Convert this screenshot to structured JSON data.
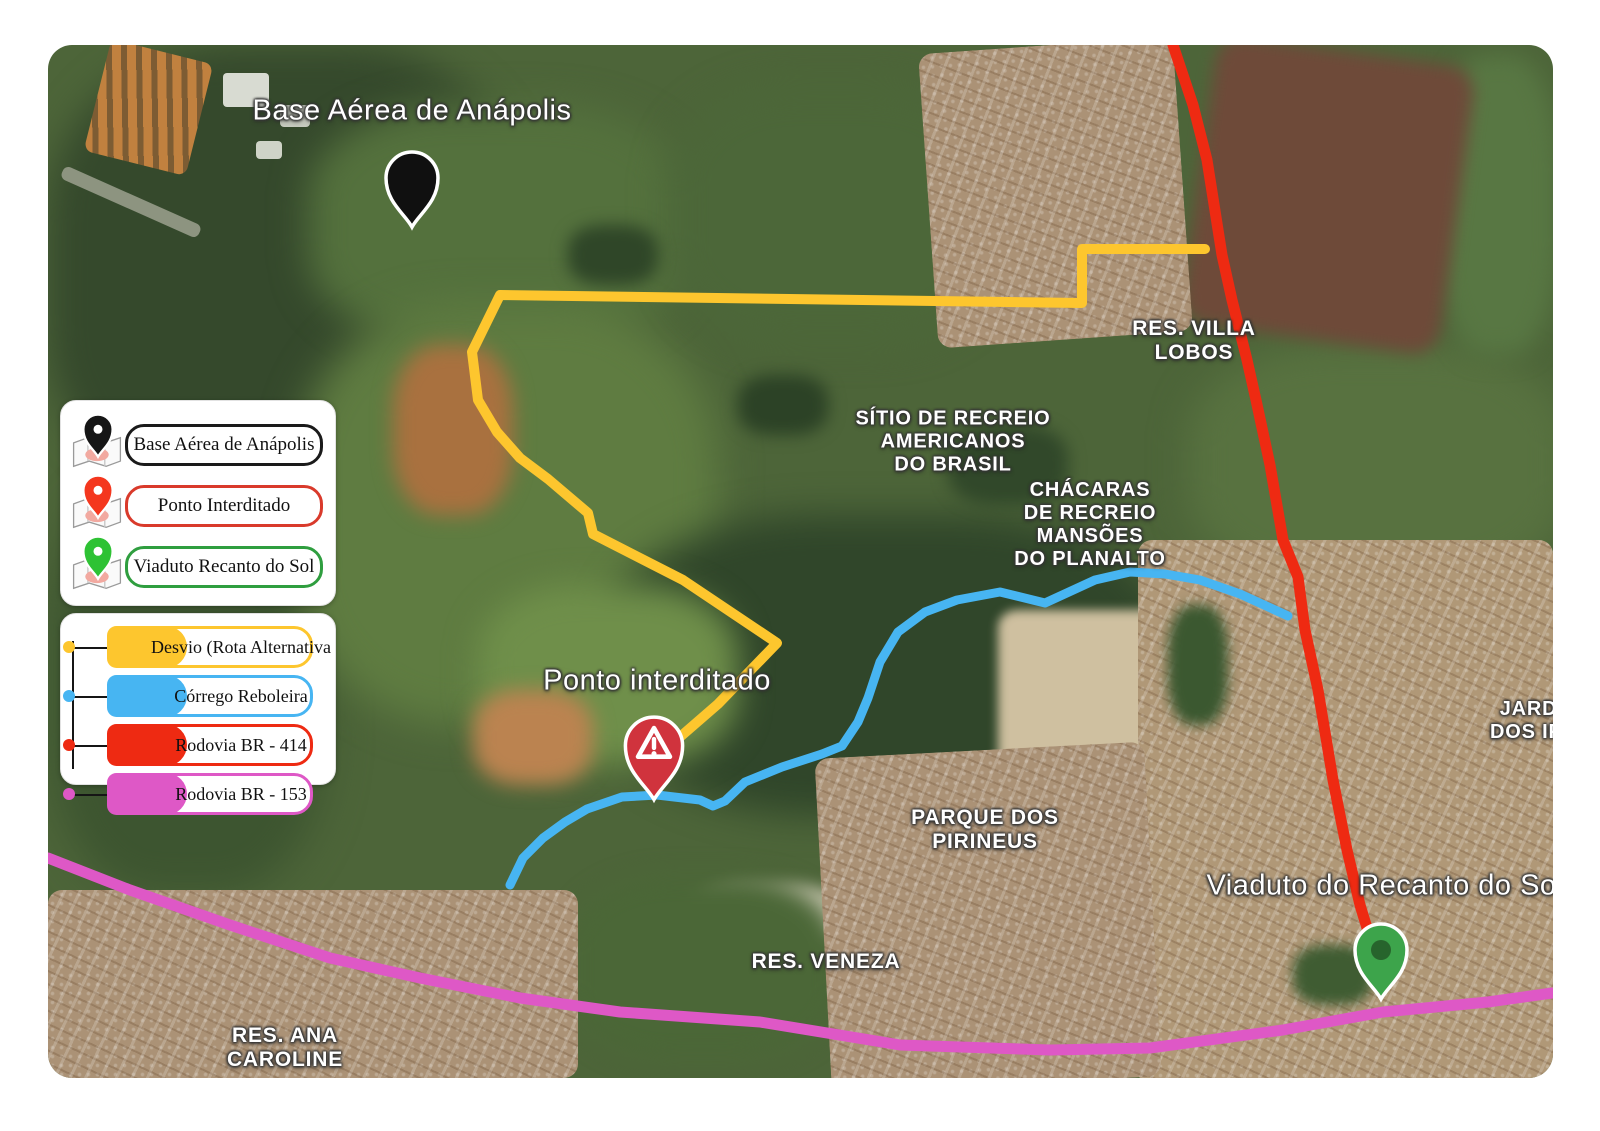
{
  "map": {
    "labels": {
      "base_aerea": "Base Aérea de Anápolis",
      "villa_lobos_l1": "RES. VILLA",
      "villa_lobos_l2": "LOBOS",
      "sitio_l1": "SÍTIO DE RECREIO",
      "sitio_l2": "AMERICANOS",
      "sitio_l3": "DO BRASIL",
      "chacaras_l1": "CHÁCARAS",
      "chacaras_l2": "DE RECREIO",
      "chacaras_l3": "MANSÕES",
      "chacaras_l4": "DO PLANALTO",
      "ponto_interditado": "Ponto interditado",
      "parque_l1": "PARQUE DOS",
      "parque_l2": "PIRINEUS",
      "res_veneza": "RES. VENEZA",
      "res_ana_l1": "RES. ANA",
      "res_ana_l2": "CAROLINE",
      "jardim_l1": "JARDIM",
      "jardim_l2": "DOS IPÊS",
      "viaduto": "Viaduto do Recanto do Sol"
    },
    "markers": {
      "base": {
        "name": "Base Aérea de Anápolis",
        "color": "#101010"
      },
      "interdito": {
        "name": "Ponto interditado",
        "color": "#d0333d"
      },
      "viaduto": {
        "name": "Viaduto do Recanto do Sol",
        "color": "#3da44b",
        "inner": "#27642c"
      }
    }
  },
  "legend": {
    "markers": [
      {
        "label": "Base Aérea de Anápolis",
        "color": "#1a1a1a",
        "pin_color": "#161616"
      },
      {
        "label": "Ponto Interditado",
        "color": "#d93a2b",
        "pin_color": "#f4371e"
      },
      {
        "label": "Viaduto Recanto do Sol",
        "color": "#2f9e3f",
        "pin_color": "#2ec234"
      }
    ],
    "routes": [
      {
        "label": "Desvio (Rota Alternativa",
        "color": "#fdc62e"
      },
      {
        "label": "Córrego Reboleira",
        "color": "#47b5f2"
      },
      {
        "label": "Rodovia BR - 414",
        "color": "#ee2a12"
      },
      {
        "label": "Rodovia BR - 153",
        "color": "#de58c6"
      }
    ]
  }
}
